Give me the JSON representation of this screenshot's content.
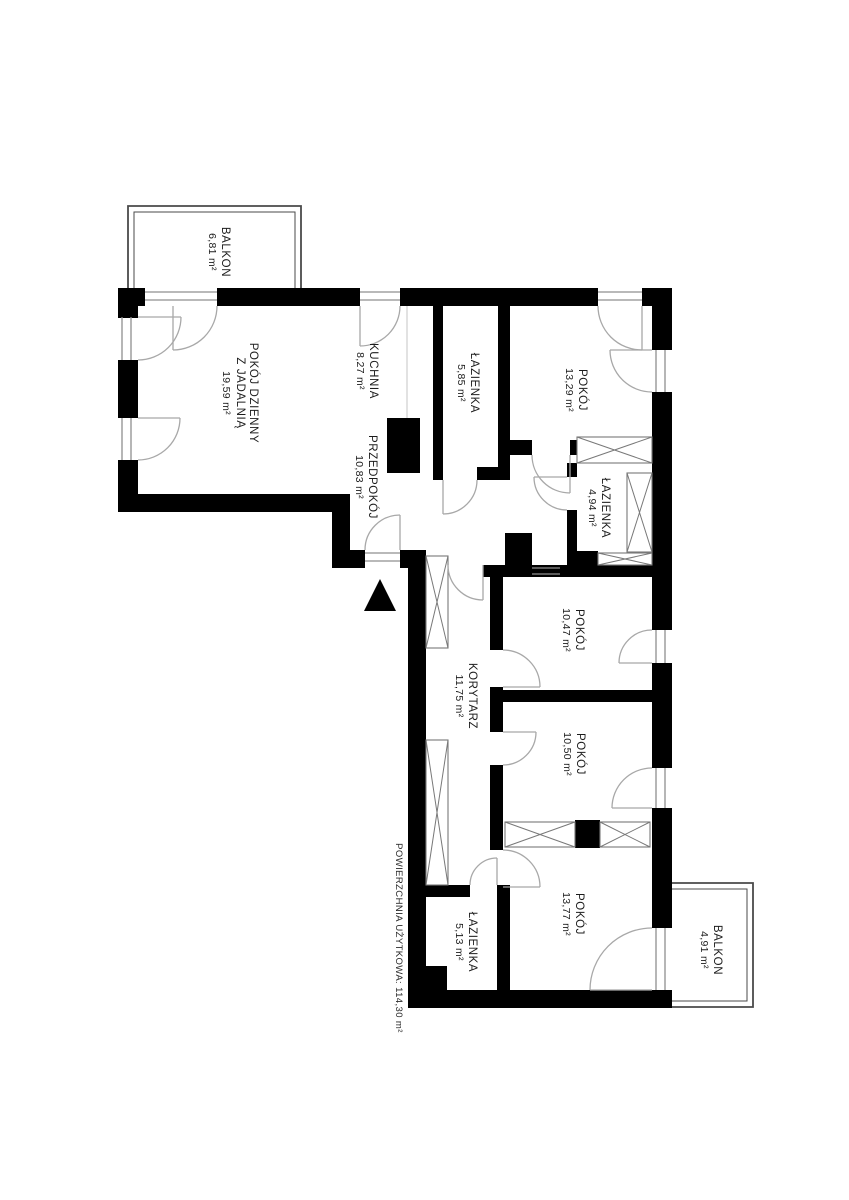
{
  "plan": {
    "type": "apartment-floor-plan",
    "rooms": {
      "balkon_top": {
        "name": "BALKON",
        "area": "6,81 m²"
      },
      "living": {
        "name": "POKÓJ DZIENNY",
        "name2": "Z JADALNIĄ",
        "area": "19,59 m²"
      },
      "kuchnia": {
        "name": "KUCHNIA",
        "area": "8,27 m²"
      },
      "lazienka1": {
        "name": "ŁAZIENKA",
        "area": "5,85 m²"
      },
      "pokoj1": {
        "name": "POKÓJ",
        "area": "13,29 m²"
      },
      "przedpokoj": {
        "name": "PRZEDPOKÓJ",
        "area": "10,83 m²"
      },
      "lazienka2": {
        "name": "ŁAZIENKA",
        "area": "4,94 m²"
      },
      "pokoj2": {
        "name": "POKÓJ",
        "area": "10,47 m²"
      },
      "korytarz": {
        "name": "KORYTARZ",
        "area": "11,75 m²"
      },
      "pokoj3": {
        "name": "POKÓJ",
        "area": "10,50 m²"
      },
      "pokoj4": {
        "name": "POKÓJ",
        "area": "13,77 m²"
      },
      "lazienka3": {
        "name": "ŁAZIENKA",
        "area": "5,13 m²"
      },
      "balkon_bottom": {
        "name": "BALKON",
        "area": "4,91 m²"
      }
    },
    "footer": {
      "total_area": "POWIERZCHNIA UŻYTKOWA: 114,30 m²"
    },
    "colors": {
      "wall": "#000000",
      "line": "#9a9a9a",
      "background": "#ffffff"
    }
  }
}
